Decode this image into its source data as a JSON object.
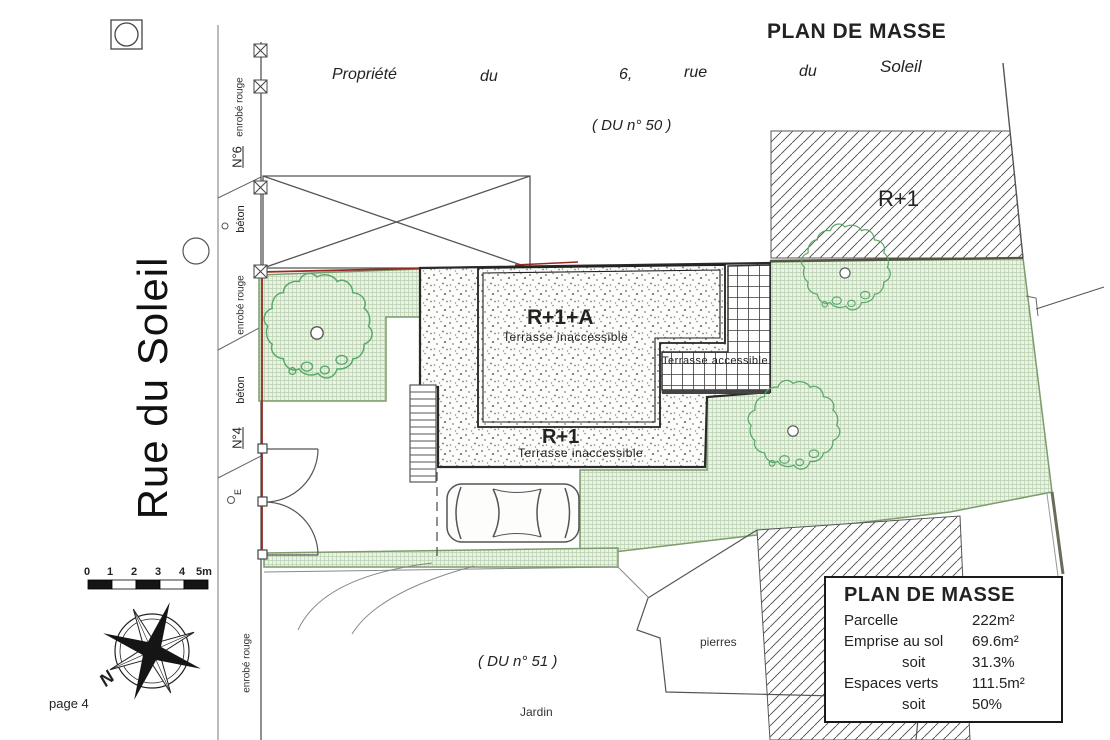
{
  "title": "PLAN DE MASSE",
  "top": {
    "property_words": [
      "Propriété",
      "du",
      "6,",
      "rue",
      "du",
      "Soleil"
    ],
    "du50": "( DU n° 50 )"
  },
  "street": {
    "name": "Rue du Soleil",
    "n6": "N°6",
    "n4": "N°4",
    "beton1": "béton",
    "beton2": "béton",
    "enrobe1": "enrobé rouge",
    "enrobe2": "enrobé rouge",
    "enrobe3": "enrobé rouge",
    "e": "E"
  },
  "buildings": {
    "neighbor_r1": "R+1",
    "main_upper": {
      "label": "R+1+A",
      "sub": "Terrasse inaccessible"
    },
    "main_lower": {
      "label": "R+1",
      "sub": "Terrasse inaccessible"
    },
    "terrace": "Terrasse accessible"
  },
  "ground": {
    "du51": "( DU n° 51 )",
    "pierres": "pierres",
    "jardin": "Jardin"
  },
  "legend": {
    "title": "PLAN DE MASSE",
    "rows": [
      {
        "label": "Parcelle",
        "value": "222m²"
      },
      {
        "label": "Emprise au sol",
        "value": "69.6m²"
      },
      {
        "label": "soit",
        "value": "31.3%"
      },
      {
        "label": "Espaces verts",
        "value": "111.5m²"
      },
      {
        "label": "soit",
        "value": "50%"
      }
    ]
  },
  "scalebar": {
    "ticks": [
      "0",
      "1",
      "2",
      "3",
      "4",
      "5m"
    ]
  },
  "compass": {
    "north": "N"
  },
  "page_label": "page 4",
  "colors": {
    "boundary_red": "#962a20",
    "green_fill": "#ebf2e6",
    "green_line": "#b9d2b0",
    "green_border": "#7d9b6d",
    "tree_green": "#57a868",
    "ink": "#222222"
  }
}
